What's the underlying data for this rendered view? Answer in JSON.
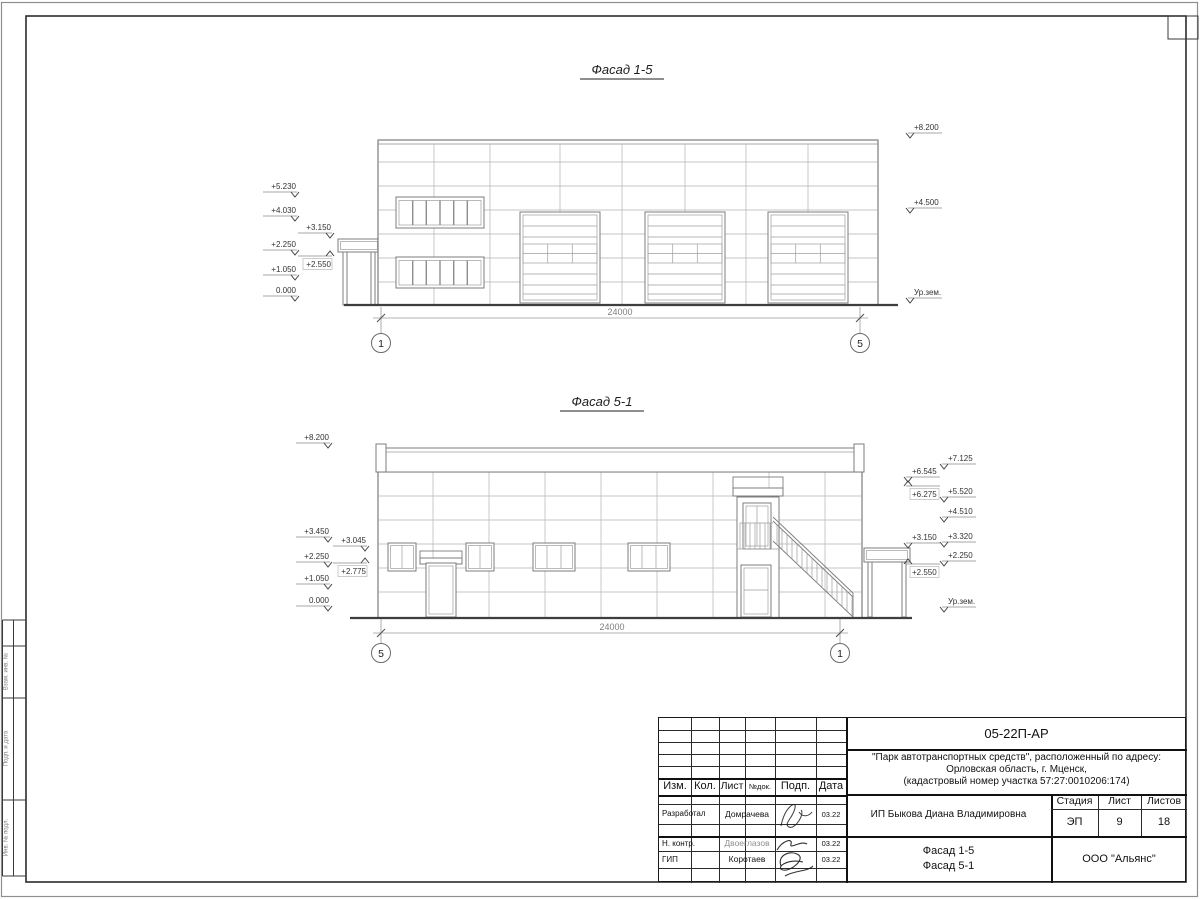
{
  "facade1": {
    "title": "Фасад 1-5",
    "dimension": "24000",
    "axis_left": "1",
    "axis_right": "5",
    "marks": [
      {
        "x": 295,
        "y": 192,
        "label": "+5.230",
        "side": "left",
        "dir": "down"
      },
      {
        "x": 295,
        "y": 216,
        "label": "+4.030",
        "side": "left",
        "dir": "down"
      },
      {
        "x": 330,
        "y": 233,
        "label": "+3.150",
        "side": "left",
        "dir": "down"
      },
      {
        "x": 295,
        "y": 250,
        "label": "+2.250",
        "side": "left",
        "dir": "down"
      },
      {
        "x": 330,
        "y": 256,
        "label": "+2.550",
        "side": "left",
        "dir": "up"
      },
      {
        "x": 295,
        "y": 275,
        "label": "+1.050",
        "side": "left",
        "dir": "down"
      },
      {
        "x": 295,
        "y": 296,
        "label": "0.000",
        "side": "left",
        "dir": "down"
      },
      {
        "x": 910,
        "y": 133,
        "label": "+8.200",
        "side": "right",
        "dir": "down"
      },
      {
        "x": 910,
        "y": 208,
        "label": "+4.500",
        "side": "right",
        "dir": "down"
      },
      {
        "x": 910,
        "y": 298,
        "label": "Ур.зем.",
        "side": "right",
        "dir": "down"
      }
    ]
  },
  "facade2": {
    "title": "Фасад 5-1",
    "dimension": "24000",
    "axis_left": "5",
    "axis_right": "1",
    "marks": [
      {
        "x": 328,
        "y": 443,
        "label": "+8.200",
        "side": "left",
        "dir": "down"
      },
      {
        "x": 328,
        "y": 537,
        "label": "+3.450",
        "side": "left",
        "dir": "down"
      },
      {
        "x": 365,
        "y": 546,
        "label": "+3.045",
        "side": "left",
        "dir": "down"
      },
      {
        "x": 328,
        "y": 562,
        "label": "+2.250",
        "side": "left",
        "dir": "down"
      },
      {
        "x": 365,
        "y": 563,
        "label": "+2.775",
        "side": "left",
        "dir": "up"
      },
      {
        "x": 328,
        "y": 584,
        "label": "+1.050",
        "side": "left",
        "dir": "down"
      },
      {
        "x": 328,
        "y": 606,
        "label": "0.000",
        "side": "left",
        "dir": "down"
      },
      {
        "x": 908,
        "y": 477,
        "label": "+6.545",
        "side": "right",
        "dir": "down"
      },
      {
        "x": 908,
        "y": 486,
        "label": "+6.275",
        "side": "right",
        "dir": "up"
      },
      {
        "x": 908,
        "y": 543,
        "label": "+3.150",
        "side": "right",
        "dir": "down"
      },
      {
        "x": 908,
        "y": 564,
        "label": "+2.550",
        "side": "right",
        "dir": "up"
      },
      {
        "x": 944,
        "y": 464,
        "label": "+7.125",
        "side": "right",
        "dir": "down"
      },
      {
        "x": 944,
        "y": 497,
        "label": "+5.520",
        "side": "right",
        "dir": "down"
      },
      {
        "x": 944,
        "y": 517,
        "label": "+4.510",
        "side": "right",
        "dir": "down"
      },
      {
        "x": 944,
        "y": 542,
        "label": "+3.320",
        "side": "right",
        "dir": "down"
      },
      {
        "x": 944,
        "y": 561,
        "label": "+2.250",
        "side": "right",
        "dir": "down"
      },
      {
        "x": 944,
        "y": 607,
        "label": "Ур.зем.",
        "side": "right",
        "dir": "down"
      }
    ]
  },
  "title_block": {
    "doc_code": "05-22П-АР",
    "project_line1": "\"Парк автотранспортных средств\",  расположенный по адресу:",
    "project_line2": "Орловская область, г. Мценск,",
    "project_line3": "(кадастровый номер участка 57:27:0010206:174)",
    "header_cols": [
      "Изм.",
      "Кол.",
      "Лист",
      "№док.",
      "Подп.",
      "Дата"
    ],
    "rows": [
      {
        "role": "Разработал",
        "name": "Домрачева",
        "date": "03.22"
      },
      {
        "role": "Н. контр.",
        "name": "Двоеглазов",
        "date": "03.22"
      },
      {
        "role": "ГИП",
        "name": "Коротаев",
        "date": "03.22"
      }
    ],
    "client": "ИП Быкова Диана Владимировна",
    "stage_label": "Стадия",
    "sheet_label": "Лист",
    "sheets_label": "Листов",
    "stage": "ЭП",
    "sheet": "9",
    "sheets": "18",
    "sheet_title_line1": "Фасад 1-5",
    "sheet_title_line2": "Фасад 5-1",
    "organization": "ООО \"Альянс\""
  },
  "side_stamp": {
    "labels": [
      "Взам. инв. №",
      "Подп. и дата",
      "Инв. № подл."
    ]
  }
}
